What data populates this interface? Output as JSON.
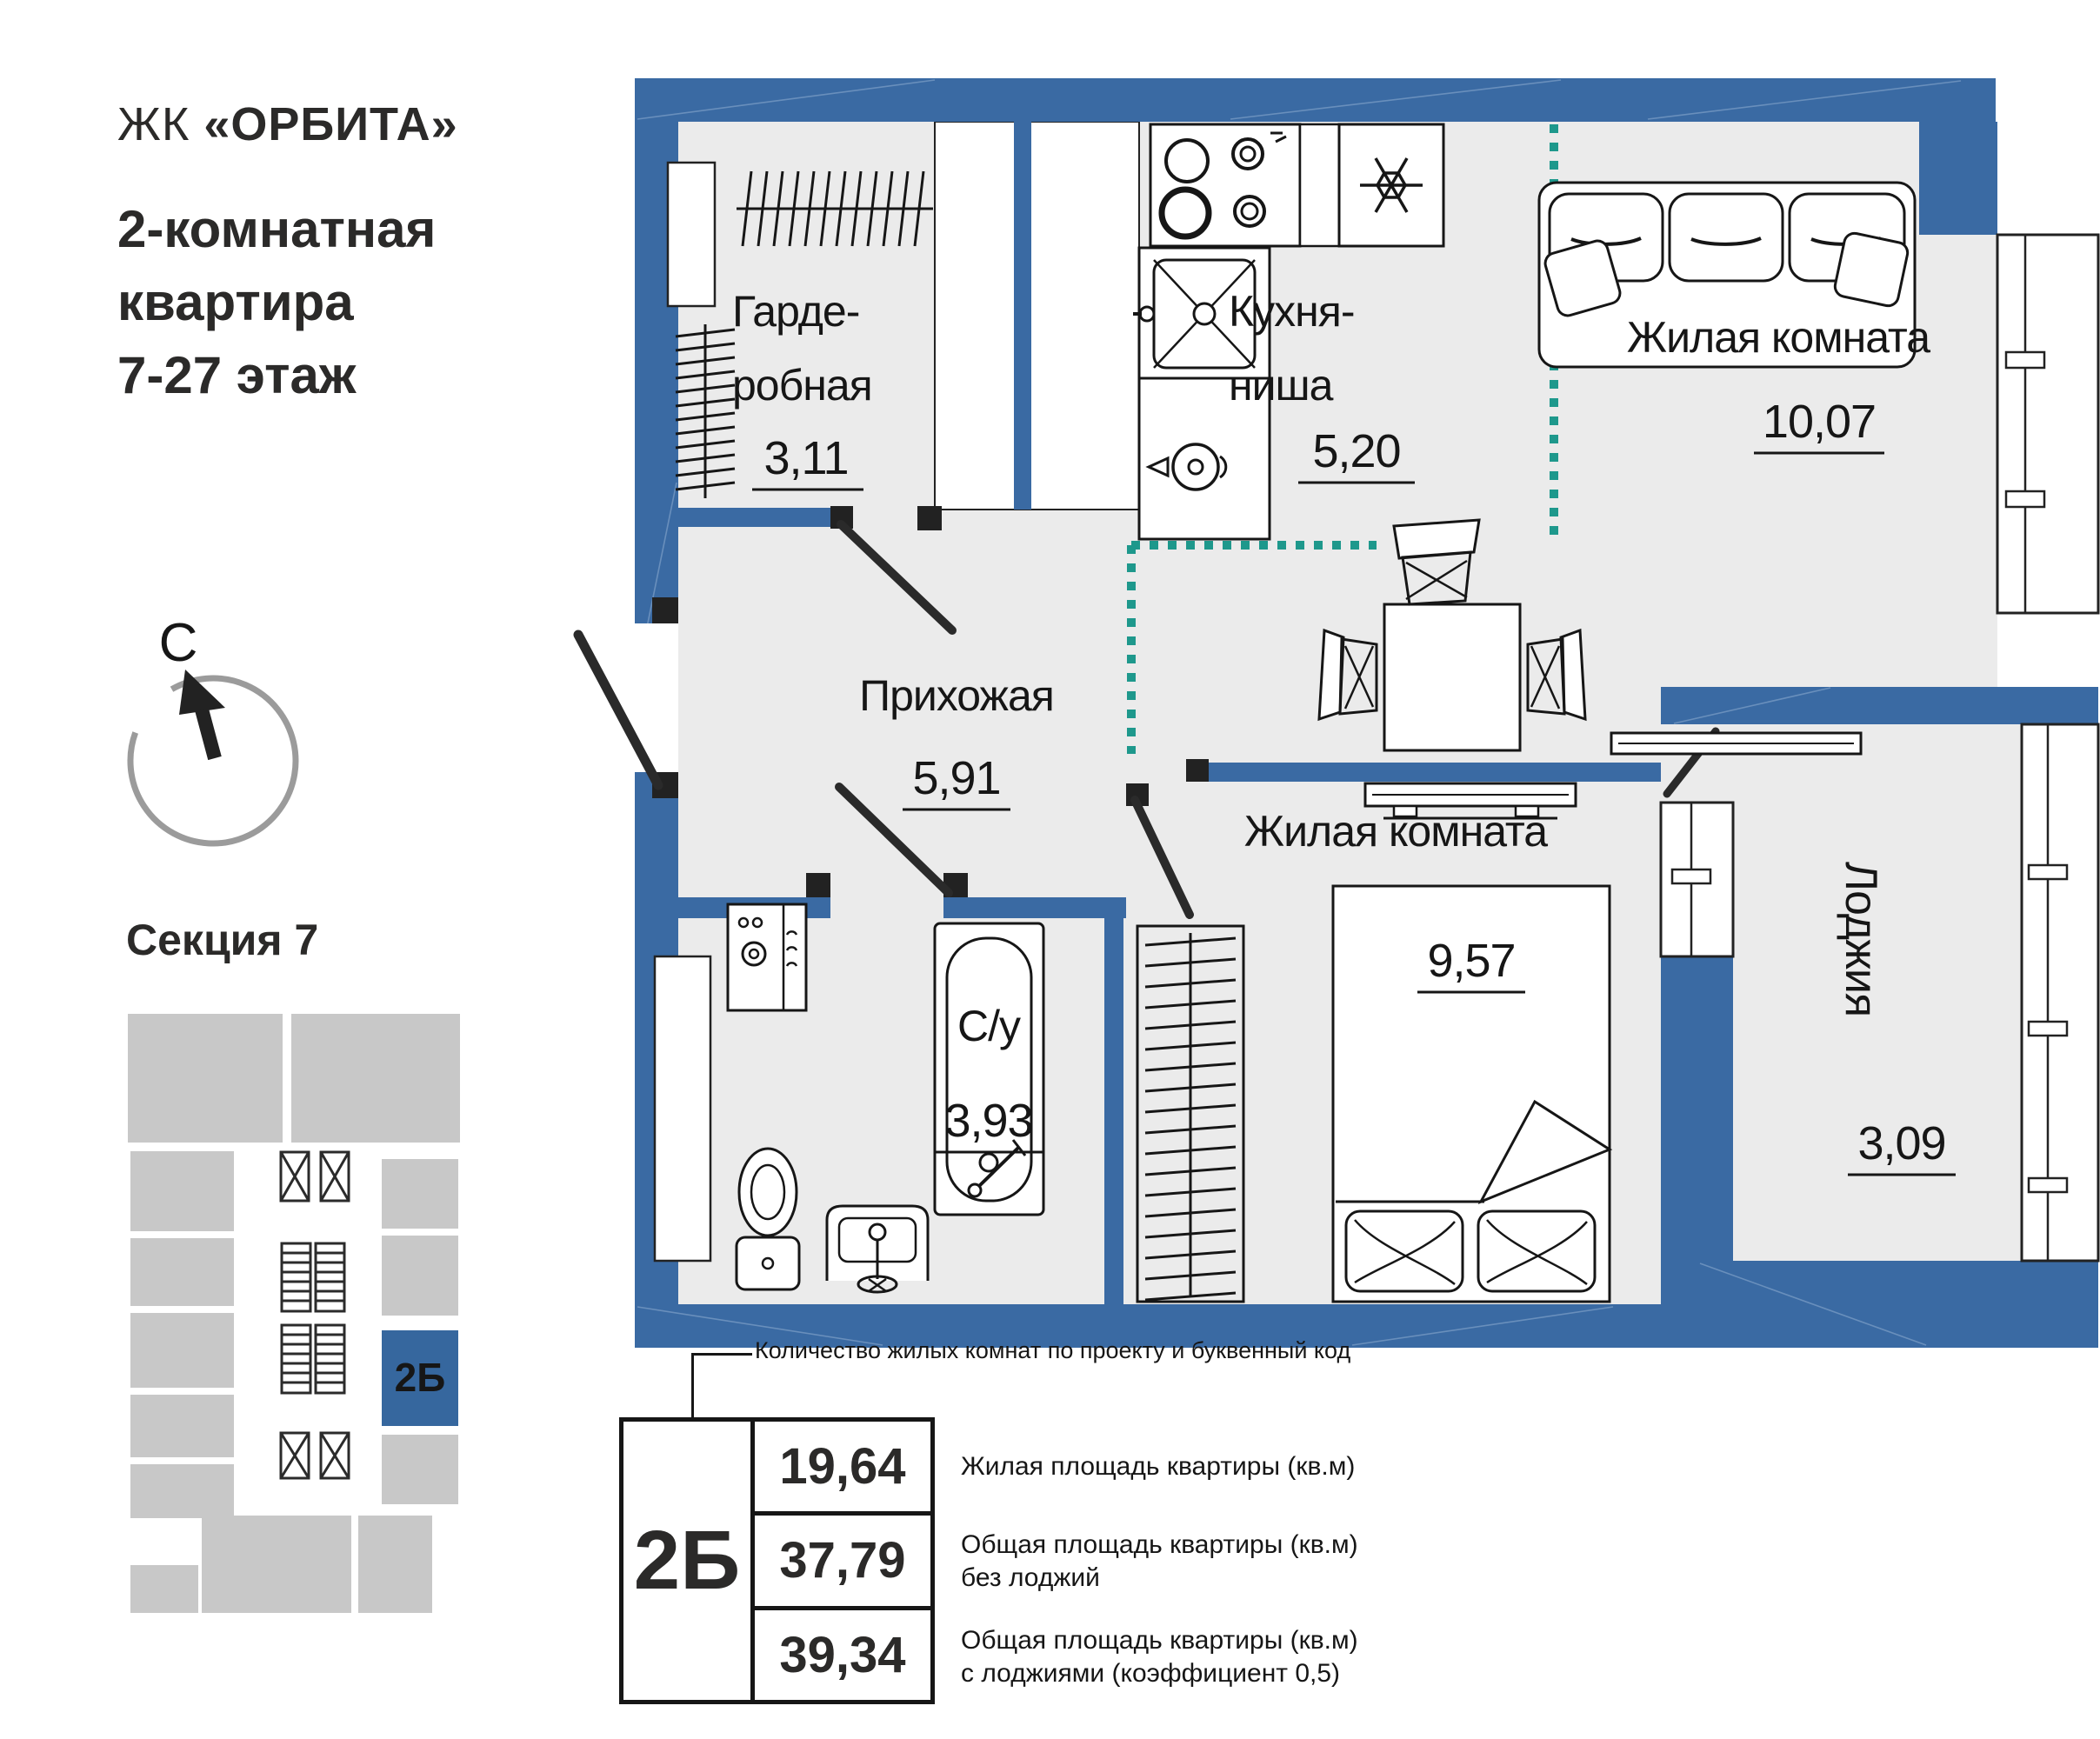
{
  "colors": {
    "wall_blue": "#3a6aa3",
    "accent_teal": "#1e988c",
    "room_fill": "#ebebeb",
    "section_gray": "#c8c8c8",
    "unit_blue": "#36679e"
  },
  "header": {
    "complex_prefix": "ЖК",
    "complex_name": "«ОРБИТА»",
    "title_lines": [
      "2-комнатная",
      "квартира",
      "7-27 этаж"
    ]
  },
  "compass": {
    "north": "С"
  },
  "section": {
    "title": "Секция 7",
    "unit_code": "2Б"
  },
  "plan": {
    "wardrobe": {
      "name_l1": "Гарде-",
      "name_l2": "робная",
      "area": "3,11"
    },
    "kitchen": {
      "name_l1": "Кухня-",
      "name_l2": "ниша",
      "area": "5,20"
    },
    "living": {
      "name": "Жилая комната",
      "area": "10,07"
    },
    "hallway": {
      "name": "Прихожая",
      "area": "5,91"
    },
    "bathroom": {
      "name": "С/у",
      "area": "3,93"
    },
    "bedroom": {
      "name": "Жилая комната",
      "area": "9,57"
    },
    "loggia": {
      "name": "Лоджия",
      "area": "3,09"
    }
  },
  "legend": {
    "callout": "Количество жилых комнат по проекту и буквенный код",
    "unit_code": "2Б",
    "rows": [
      {
        "value": "19,64",
        "label_l1": "Жилая площадь квартиры (кв.м)",
        "label_l2": ""
      },
      {
        "value": "37,79",
        "label_l1": "Общая площадь квартиры (кв.м)",
        "label_l2": "без лоджий"
      },
      {
        "value": "39,34",
        "label_l1": "Общая площадь квартиры (кв.м)",
        "label_l2": "с лоджиями (коэффициент 0,5)"
      }
    ]
  }
}
